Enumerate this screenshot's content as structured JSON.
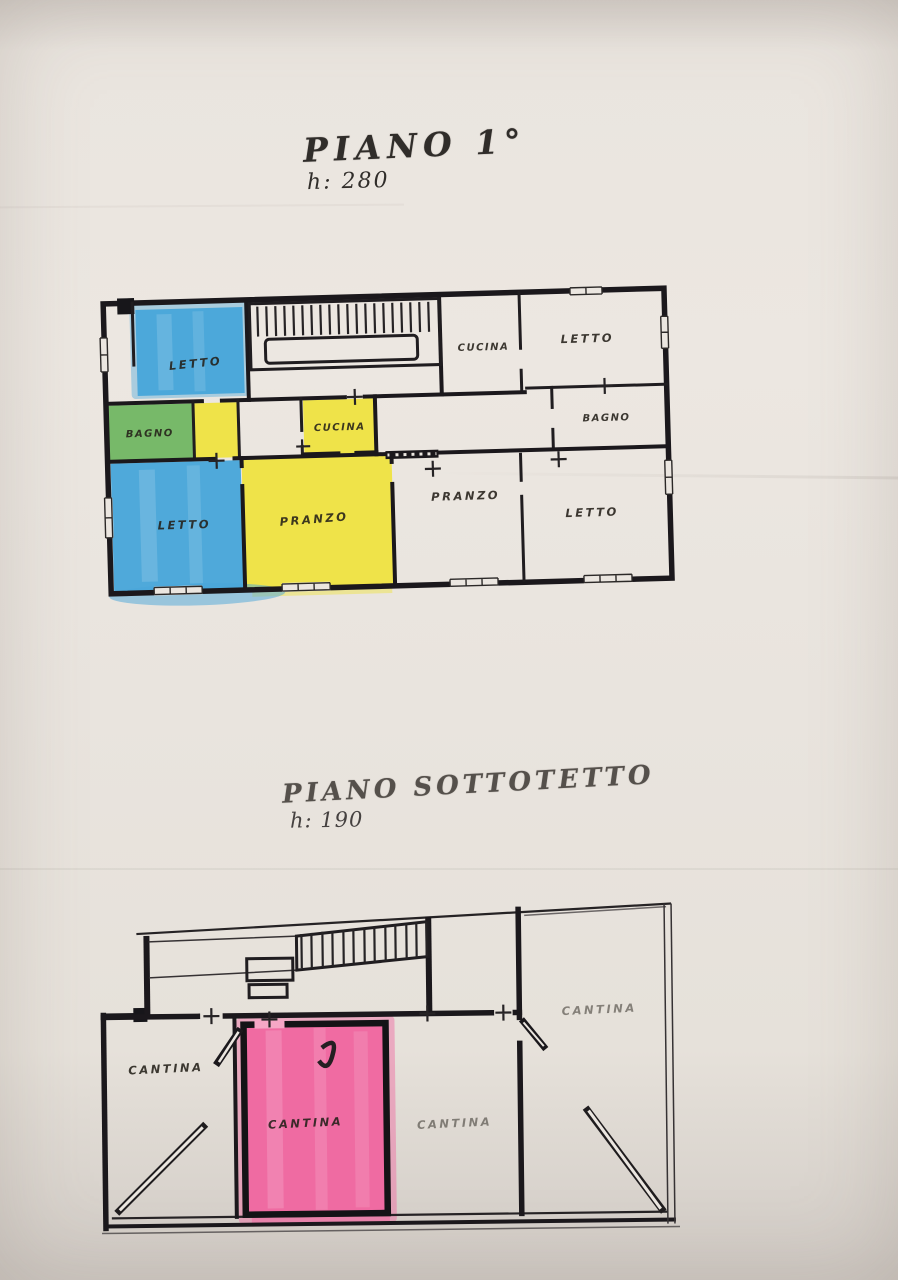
{
  "paper": {
    "background": "#eae5df",
    "ink": "#1b181c"
  },
  "plan1": {
    "title": "PIANO 1°",
    "height_note": "h: 280",
    "colors": {
      "blue": "#47a5d9",
      "green": "#6ab45c",
      "yellow": "#efe33c"
    },
    "rooms": {
      "letto_top_left": "LETTO",
      "cucina_top": "CUCINA",
      "letto_top_right": "LETTO",
      "bagno_left": "BAGNO",
      "cucina_small": "CUCINA",
      "bagno_right": "BAGNO",
      "letto_bottom_left": "LETTO",
      "pranzo_left": "PRANZO",
      "pranzo_right": "PRANZO",
      "letto_bottom_right": "LETTO"
    }
  },
  "plan2": {
    "title": "PIANO SOTTOTETTO",
    "height_note": "h: 190",
    "colors": {
      "pink": "#f0669f"
    },
    "rooms": {
      "cantina_left": "CANTINA",
      "cantina_pink": "CANTINA",
      "cantina_center": "CANTINA",
      "cantina_right": "CANTINA"
    }
  }
}
